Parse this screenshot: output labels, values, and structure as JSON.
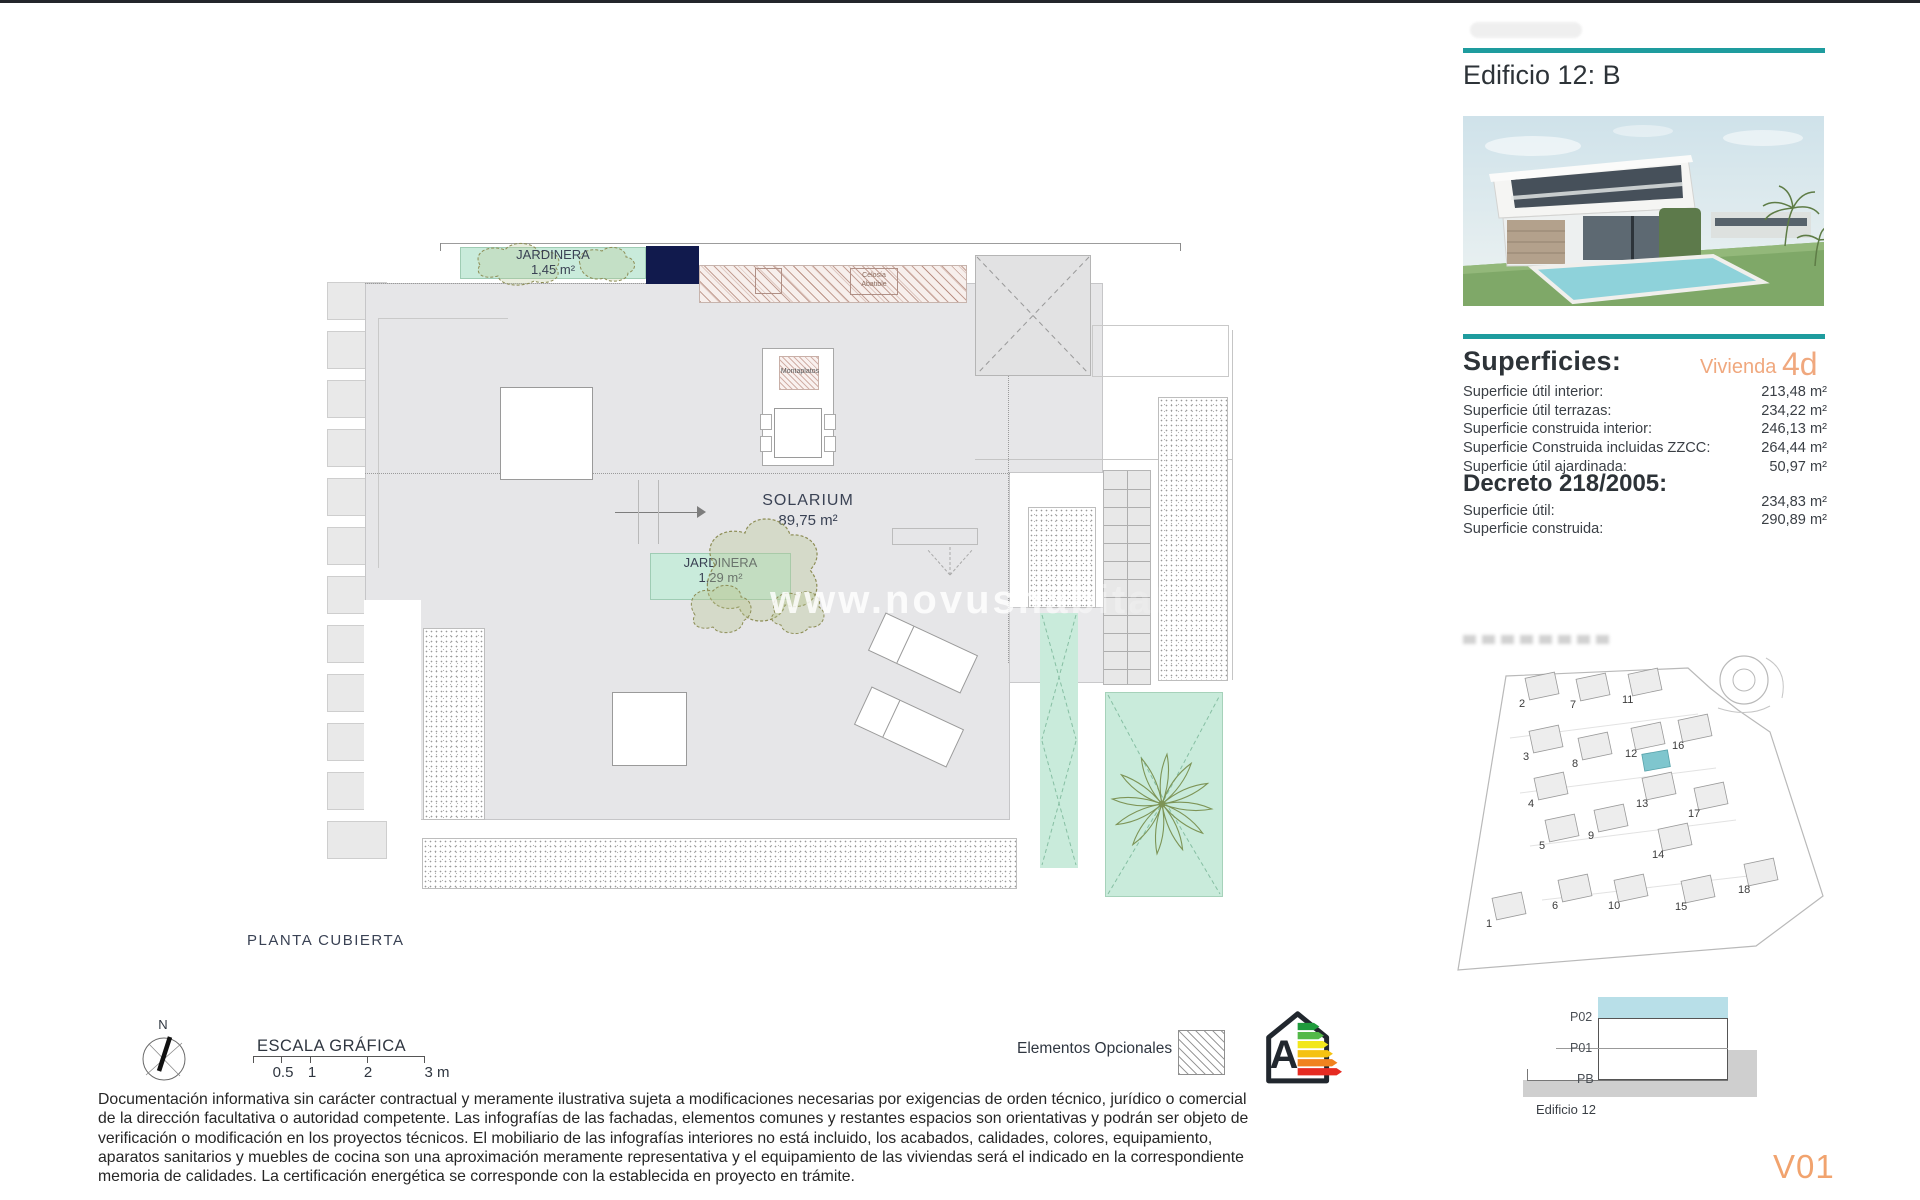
{
  "header": {
    "building_title": "Edificio 12: B"
  },
  "superficies": {
    "title": "Superficies:",
    "unit_label": "Vivienda",
    "unit_code": "4d",
    "rows": [
      {
        "label": "Superficie útil interior:",
        "value": "213,48 m²"
      },
      {
        "label": "Superficie útil terrazas:",
        "value": "234,22 m²"
      },
      {
        "label": "Superficie construida interior:",
        "value": "246,13 m²"
      },
      {
        "label": "Superficie Construida incluidas ZZCC:",
        "value": "264,44 m²"
      },
      {
        "label": "Superficie útil ajardinada:",
        "value": "50,97 m²"
      }
    ]
  },
  "decreto": {
    "title": "Decreto 218/2005:",
    "rows": [
      {
        "label": "Superficie útil:",
        "value": "234,83 m²"
      },
      {
        "label": "Superficie construida:",
        "value": "290,89 m²"
      }
    ]
  },
  "plan": {
    "caption": "PLANTA CUBIERTA",
    "watermark": "www.novushabitat",
    "solarium": {
      "name": "SOLARIUM",
      "area": "89,75 m²"
    },
    "jardinera_top": {
      "name": "JARDINERA",
      "area": "1,45 m²"
    },
    "jardinera_mid": {
      "name": "JARDINERA",
      "area": "1,29 m²"
    },
    "montaplatos_label": "Montaplatos",
    "pergola_label_line1": "Celosía",
    "pergola_label_line2": "Abatible"
  },
  "legend": {
    "north_label": "N",
    "scale_title": "ESCALA GRÁFICA",
    "scale_ticks": [
      "0.5",
      "1",
      "2",
      "3 m"
    ],
    "optional_label": "Elementos Opcionales",
    "energy_letter": "A",
    "energy_colors": [
      "#1f9b3c",
      "#53b948",
      "#f2e71c",
      "#f5c211",
      "#f0821f",
      "#e62b22"
    ]
  },
  "section": {
    "floors": [
      "P02",
      "P01",
      "PB"
    ],
    "caption": "Edificio 12",
    "version": "V01"
  },
  "siteplan": {
    "highlight_color": "#7fc6ce",
    "plots": [
      {
        "n": "1",
        "x": 38,
        "y": 309
      },
      {
        "n": "2",
        "x": 71,
        "y": 89
      },
      {
        "n": "3",
        "x": 75,
        "y": 142
      },
      {
        "n": "4",
        "x": 80,
        "y": 189
      },
      {
        "n": "5",
        "x": 91,
        "y": 231
      },
      {
        "n": "6",
        "x": 104,
        "y": 291
      },
      {
        "n": "7",
        "x": 122,
        "y": 90
      },
      {
        "n": "8",
        "x": 124,
        "y": 149
      },
      {
        "n": "9",
        "x": 140,
        "y": 221
      },
      {
        "n": "10",
        "x": 160,
        "y": 291
      },
      {
        "n": "11",
        "x": 174,
        "y": 85
      },
      {
        "n": "12",
        "x": 177,
        "y": 139
      },
      {
        "n": "13",
        "x": 188,
        "y": 189
      },
      {
        "n": "14",
        "x": 204,
        "y": 240
      },
      {
        "n": "15",
        "x": 227,
        "y": 292
      },
      {
        "n": "16",
        "x": 224,
        "y": 131
      },
      {
        "n": "17",
        "x": 240,
        "y": 199
      },
      {
        "n": "18",
        "x": 290,
        "y": 275
      }
    ]
  },
  "disclaimer": {
    "lines": [
      "Documentación informativa sin carácter contractual y meramente ilustrativa sujeta a modificaciones necesarias por exigencias de orden técnico, jurídico o comercial",
      "de la dirección facultativa o autoridad competente. Las infografías de las fachadas, elementos comunes y restantes espacios son orientativas y podrán ser objeto de",
      "verificación o modificación en los proyectos técnicos. El mobiliario de las infografías interiores no está incluido, los acabados, calidades, colores, equipamiento,",
      "aparatos sanitarios y muebles de cocina son una aproximación meramente representativa y el equipamiento de las viviendas será el indicado en la correspondiente",
      "memoria de calidades. La certificación energética se corresponde con la establecida en proyecto en trámite."
    ]
  },
  "colors": {
    "teal": "#1e9c9e",
    "accent": "#f0a87e",
    "mint": "#c9ebdb",
    "navy": "#111a4d"
  }
}
